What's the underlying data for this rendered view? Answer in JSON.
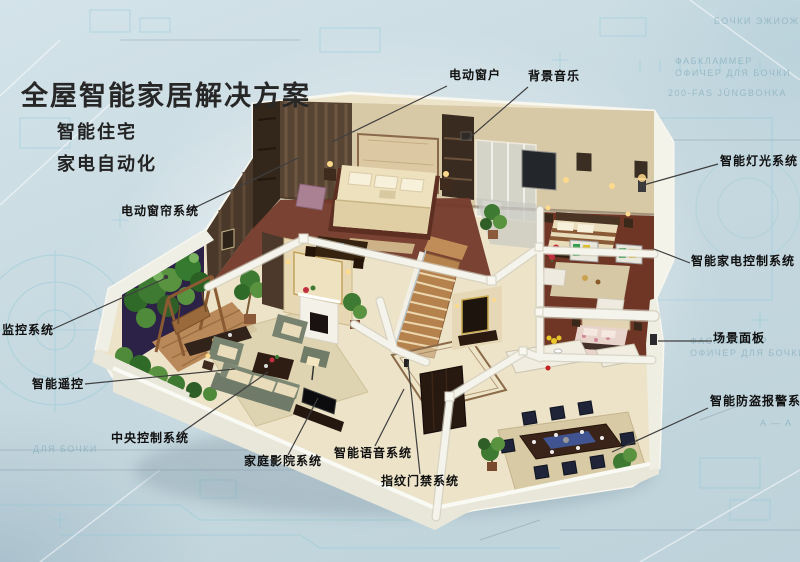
{
  "title": "全屋智能家居解决方案",
  "subtitles": [
    "智能住宅",
    "家电自动化"
  ],
  "callouts": [
    {
      "id": "motorized-window",
      "label": "电动窗户"
    },
    {
      "id": "background-music",
      "label": "背景音乐"
    },
    {
      "id": "smart-lighting",
      "label": "智能灯光系统"
    },
    {
      "id": "appliance-control",
      "label": "智能家电控制系统"
    },
    {
      "id": "scene-panel",
      "label": "场景面板"
    },
    {
      "id": "burglar-alarm",
      "label": "智能防盗报警系统"
    },
    {
      "id": "motorized-curtain",
      "label": "电动窗帘系统"
    },
    {
      "id": "monitoring-system",
      "label": "监控系统"
    },
    {
      "id": "smart-remote",
      "label": "智能遥控"
    },
    {
      "id": "central-control",
      "label": "中央控制系统"
    },
    {
      "id": "home-theater",
      "label": "家庭影院系统"
    },
    {
      "id": "voice-system",
      "label": "智能语音系统"
    },
    {
      "id": "fingerprint-access",
      "label": "指纹门禁系统"
    }
  ],
  "watermarks": [
    "БОЧКИ ЭЖИОЖИ",
    "ФАБКЛАММЕР",
    "ОФИЧЕР ДЛЯ БОЧКИ",
    "200-FAS JÜNGBOHKA",
    "ФАСКЛАММЕР",
    "ОФИЧЕР ДЛЯ БОЧКИ",
    "A — A",
    "ДЛЯ БОЧКИ",
    "min 820"
  ],
  "palette": {
    "background": "#c7d9e0",
    "blueprint_line": "#8fc8d6",
    "title_text": "#272727",
    "label_text": "#101010",
    "leader_line": "#3f3f3f",
    "floor_cream": "#ece3c9",
    "wall_white": "#f5f4ec",
    "wood_floor": "#73392a",
    "back_wall_tan": "#d7c8a6",
    "plant_green": "#3f7a33",
    "night_view_purple": "#2c2147",
    "table_runner_blue": "#3f5490"
  }
}
